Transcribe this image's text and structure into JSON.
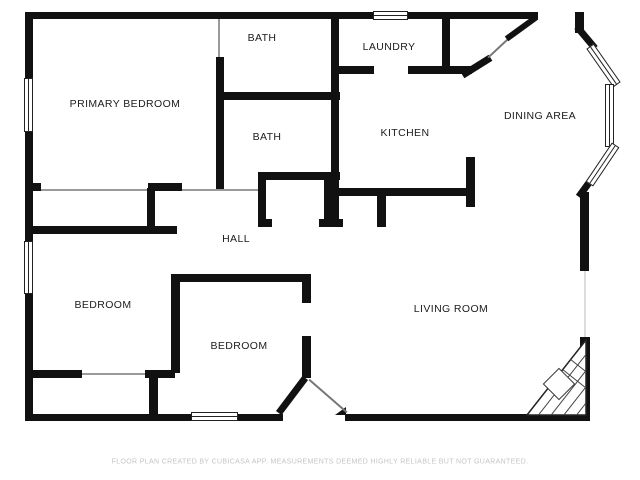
{
  "rooms": {
    "primary_bedroom": {
      "label": "PRIMARY BEDROOM"
    },
    "bath_upper": {
      "label": "BATH"
    },
    "bath_lower": {
      "label": "BATH"
    },
    "laundry": {
      "label": "LAUNDRY"
    },
    "kitchen": {
      "label": "KITCHEN"
    },
    "dining_area": {
      "label": "DINING AREA"
    },
    "hall": {
      "label": "HALL"
    },
    "bedroom_left": {
      "label": "BEDROOM"
    },
    "bedroom_lower": {
      "label": "BEDROOM"
    },
    "living_room": {
      "label": "LIVING ROOM"
    }
  },
  "footer": {
    "disclaimer": "FLOOR PLAN CREATED BY CUBICASA APP. MEASUREMENTS DEEMED HIGHLY RELIABLE BUT NOT GUARANTEED."
  },
  "icons": {
    "fireplace": "corner-fireplace-hatched-triangle"
  },
  "colors": {
    "wall": "#111111",
    "background": "#ffffff",
    "label": "#1c1c1c",
    "disclaimer": "#c4c4c4"
  }
}
